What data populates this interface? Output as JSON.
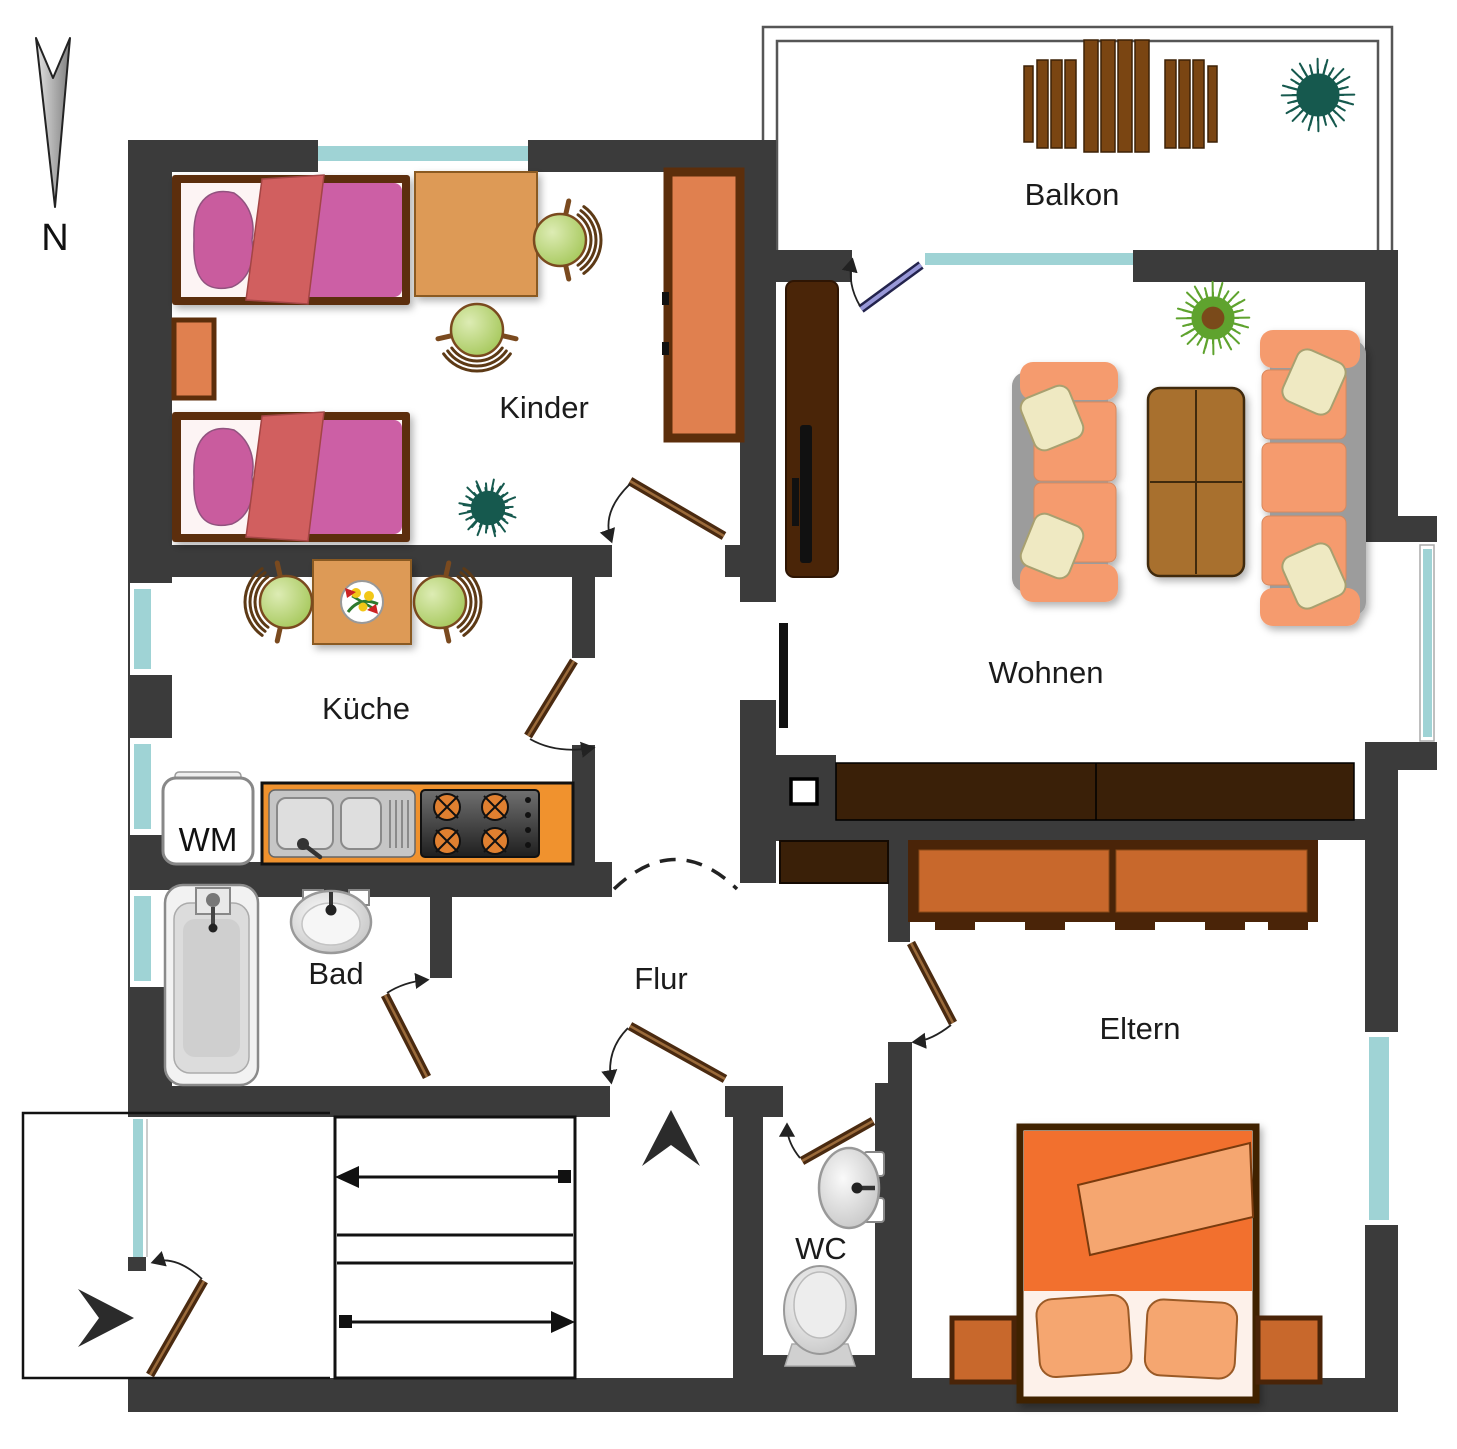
{
  "compass": {
    "label": "N"
  },
  "rooms": {
    "balkon": {
      "label": "Balkon"
    },
    "kinder": {
      "label": "Kinder"
    },
    "wohnen": {
      "label": "Wohnen"
    },
    "kueche": {
      "label": "Küche"
    },
    "bad": {
      "label": "Bad"
    },
    "flur": {
      "label": "Flur"
    },
    "wc": {
      "label": "WC"
    },
    "eltern": {
      "label": "Eltern"
    }
  },
  "appliances": {
    "washing_machine": "WM"
  },
  "colors": {
    "wall": "#3b3b3b",
    "window": "#9fd3d5",
    "door-leaf": "#4a2a10",
    "door-leaf-stripe": "#9a6a3a",
    "balcony-door": "#9898d8",
    "kid-bed-mattress": "#cc5fa5",
    "kid-bed-pillow": "#c95c9e",
    "kid-bed-blanket": "#d15f5f",
    "wood-light": "#dd9a57",
    "wood-orange": "#e0804f",
    "wood-dark": "#5c2e0b",
    "chair-green": "#b9d57f",
    "sofa-orange": "#f59b6e",
    "sofa-frame": "#9c9c9c",
    "pillow-cream": "#efe9c2",
    "table-brown": "#a8702e",
    "cabinet-dark": "#4a2508",
    "sideboard-dark": "#3a2008",
    "eltern-wood": "#c8682c",
    "eltern-blanket": "#f2702e",
    "eltern-blanket-light": "#f5a670",
    "counter-orange": "#f0922e",
    "balcony-wood": "#7a4512",
    "plant-dark": "#16594e",
    "plant-green": "#5fa32e",
    "plant-core": "#7a4a1a",
    "fixture-gray": "#d9d9d9"
  }
}
